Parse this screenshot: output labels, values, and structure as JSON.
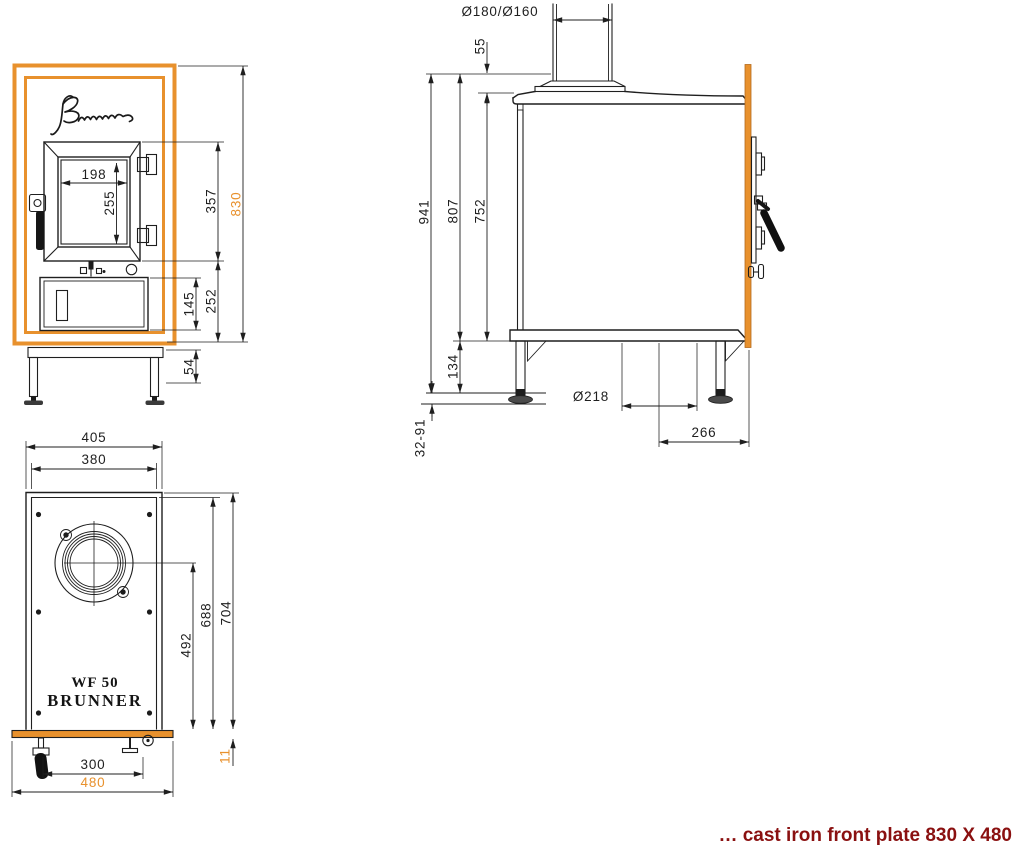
{
  "branding": {
    "signature": "Brunner",
    "model_line1": "WF 50",
    "model_line2": "BRUNNER"
  },
  "caption": {
    "text": "… cast iron front plate 830 X 480"
  },
  "colors": {
    "accent_orange": "#E8912D",
    "line_black": "#1F1F1F",
    "caption_red": "#8A1010"
  },
  "views": {
    "front": {
      "dims": {
        "glass_width": "198",
        "glass_height": "255",
        "door_outer_height": "357",
        "front_plate_height": "830",
        "lower_zone_height": "252",
        "ash_door_height": "145",
        "base_frame_height": "54"
      }
    },
    "side": {
      "dims": {
        "flue_pipe_diameter": "Ø180/Ø160",
        "flue_collar_height": "55",
        "overall_height": "941",
        "height_to_base": "807",
        "body_height": "752",
        "base_clearance": "134",
        "foot_adjustment_range": "32-91",
        "bottom_opening_diameter": "Ø218",
        "bottom_opening_distance": "266"
      }
    },
    "top": {
      "dims": {
        "body_outer_width": "405",
        "body_inner_width": "380",
        "flue_center_from_front": "492",
        "body_inner_depth": "688",
        "body_outer_depth": "704",
        "latch_span": "300",
        "front_plate_width": "480",
        "front_plate_thickness": "11"
      }
    }
  }
}
